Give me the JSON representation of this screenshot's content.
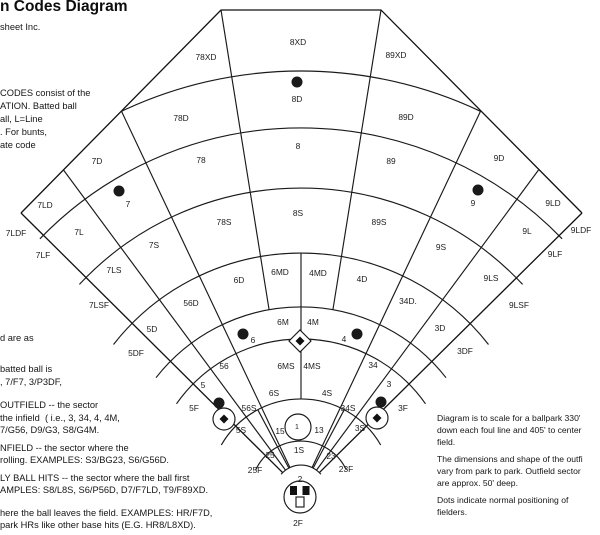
{
  "header": {
    "title": "n Codes Diagram",
    "subtitle": "sheet Inc."
  },
  "text_blocks": {
    "intro": {
      "x": 0,
      "lines": [
        {
          "text": "CODES consist of the",
          "y": 87
        },
        {
          "text": "ATION. Batted ball",
          "y": 100
        },
        {
          "text": "all, L=Line",
          "y": 113
        },
        {
          "text": ". For bunts,",
          "y": 126
        },
        {
          "text": "ate code",
          "y": 139
        }
      ]
    },
    "mid_left": {
      "x": 0,
      "lines": [
        {
          "text": "d are as",
          "y": 332
        },
        {
          "text": "batted ball is",
          "y": 363
        },
        {
          "text": ", 7/F7, 3/P3DF,",
          "y": 376
        }
      ]
    },
    "lower_left": {
      "x": 0,
      "lines": [
        {
          "text": "OUTFIELD -- the sector",
          "y": 399
        },
        {
          "text": "the infield  ( i.e., 3, 34, 4, 4M,",
          "y": 412
        },
        {
          "text": "7/G56, D9/G3, S8/G4M.",
          "y": 424
        },
        {
          "text": "NFIELD -- the sector where the",
          "y": 442
        },
        {
          "text": "rolling. EXAMPLES: S3/BG23, S6/G56D.",
          "y": 454
        },
        {
          "text": "LY BALL HITS -- the sector where the ball first",
          "y": 472
        },
        {
          "text": "AMPLES: S8/L8S, S6/P56D, D7/F7LD, T9/F89XD.",
          "y": 484
        },
        {
          "text": "here the ball leaves the field. EXAMPLES: HR/F7D,",
          "y": 507
        },
        {
          "text": "park HRs like other base hits (E.G. HR8/L8XD).",
          "y": 519
        }
      ]
    },
    "right": {
      "x": 437,
      "lines": [
        {
          "text": "Diagram is to scale for a ballpark 330'",
          "y": 412
        },
        {
          "text": "down each foul line and 405' to center",
          "y": 424
        },
        {
          "text": "field.",
          "y": 436
        },
        {
          "text": "The dimensions and shape of the outfi",
          "y": 453
        },
        {
          "text": "vary from park to park. Outfield sector",
          "y": 465
        },
        {
          "text": "are approx. 50' deep.",
          "y": 477
        },
        {
          "text": "Dots indicate normal positioning of",
          "y": 494
        },
        {
          "text": "fielders.",
          "y": 506
        }
      ]
    }
  },
  "field": {
    "sector_labels": [
      {
        "t": "78XD",
        "x": 206,
        "y": 57
      },
      {
        "t": "8XD",
        "x": 298,
        "y": 42
      },
      {
        "t": "89XD",
        "x": 396,
        "y": 55
      },
      {
        "t": "78D",
        "x": 181,
        "y": 118
      },
      {
        "t": "8D",
        "x": 297,
        "y": 99
      },
      {
        "t": "89D",
        "x": 406,
        "y": 117
      },
      {
        "t": "7D",
        "x": 97,
        "y": 161
      },
      {
        "t": "78",
        "x": 201,
        "y": 160
      },
      {
        "t": "8",
        "x": 298,
        "y": 146
      },
      {
        "t": "89",
        "x": 391,
        "y": 161
      },
      {
        "t": "9D",
        "x": 499,
        "y": 158
      },
      {
        "t": "7LD",
        "x": 45,
        "y": 205
      },
      {
        "t": "7",
        "x": 128,
        "y": 204
      },
      {
        "t": "78S",
        "x": 224,
        "y": 222
      },
      {
        "t": "8S",
        "x": 298,
        "y": 213
      },
      {
        "t": "89S",
        "x": 379,
        "y": 222
      },
      {
        "t": "9",
        "x": 473,
        "y": 203
      },
      {
        "t": "9LD",
        "x": 553,
        "y": 203
      },
      {
        "t": "7LDF",
        "x": 16,
        "y": 233
      },
      {
        "t": "7L",
        "x": 79,
        "y": 232
      },
      {
        "t": "7S",
        "x": 154,
        "y": 245
      },
      {
        "t": "9S",
        "x": 441,
        "y": 247
      },
      {
        "t": "9L",
        "x": 527,
        "y": 231
      },
      {
        "t": "9LDF",
        "x": 581,
        "y": 230
      },
      {
        "t": "7LF",
        "x": 43,
        "y": 255
      },
      {
        "t": "7LS",
        "x": 114,
        "y": 270
      },
      {
        "t": "9LS",
        "x": 491,
        "y": 278
      },
      {
        "t": "9LF",
        "x": 555,
        "y": 254
      },
      {
        "t": "7LSF",
        "x": 99,
        "y": 305
      },
      {
        "t": "56D",
        "x": 191,
        "y": 303
      },
      {
        "t": "6D",
        "x": 239,
        "y": 280
      },
      {
        "t": "6MD",
        "x": 280,
        "y": 272
      },
      {
        "t": "4MD",
        "x": 318,
        "y": 273
      },
      {
        "t": "4D",
        "x": 362,
        "y": 279
      },
      {
        "t": "34D.",
        "x": 408,
        "y": 301
      },
      {
        "t": "9LSF",
        "x": 519,
        "y": 305
      },
      {
        "t": "5D",
        "x": 152,
        "y": 329
      },
      {
        "t": "6M",
        "x": 283,
        "y": 322
      },
      {
        "t": "4M",
        "x": 313,
        "y": 322
      },
      {
        "t": "3D",
        "x": 440,
        "y": 328
      },
      {
        "t": "5DF",
        "x": 136,
        "y": 353
      },
      {
        "t": "6",
        "x": 253,
        "y": 340
      },
      {
        "t": "4",
        "x": 344,
        "y": 339
      },
      {
        "t": "3DF",
        "x": 465,
        "y": 351
      },
      {
        "t": "56",
        "x": 224,
        "y": 366
      },
      {
        "t": "6MS",
        "x": 286,
        "y": 366
      },
      {
        "t": "4MS",
        "x": 312,
        "y": 366
      },
      {
        "t": "34",
        "x": 373,
        "y": 365
      },
      {
        "t": "5",
        "x": 203,
        "y": 385
      },
      {
        "t": "6S",
        "x": 274,
        "y": 393
      },
      {
        "t": "4S",
        "x": 327,
        "y": 393
      },
      {
        "t": "3",
        "x": 389,
        "y": 384
      },
      {
        "t": "5F",
        "x": 194,
        "y": 408
      },
      {
        "t": "56S",
        "x": 249,
        "y": 408
      },
      {
        "t": "34S",
        "x": 348,
        "y": 408
      },
      {
        "t": "3F",
        "x": 403,
        "y": 408
      },
      {
        "t": "5S",
        "x": 241,
        "y": 430
      },
      {
        "t": "15",
        "x": 280,
        "y": 431
      },
      {
        "t": "1",
        "x": 297,
        "y": 426,
        "s": "small"
      },
      {
        "t": "13",
        "x": 319,
        "y": 430
      },
      {
        "t": "3S",
        "x": 360,
        "y": 428
      },
      {
        "t": "25",
        "x": 270,
        "y": 455
      },
      {
        "t": "1S",
        "x": 299,
        "y": 450
      },
      {
        "t": "23",
        "x": 331,
        "y": 456
      },
      {
        "t": "25F",
        "x": 255,
        "y": 470
      },
      {
        "t": "23F",
        "x": 346,
        "y": 469
      },
      {
        "t": "2",
        "x": 300,
        "y": 479
      },
      {
        "t": "2F",
        "x": 298,
        "y": 523
      }
    ],
    "fielder_dots": [
      {
        "pos": "center-fielder-8",
        "x": 297,
        "y": 82
      },
      {
        "pos": "left-fielder-7",
        "x": 119,
        "y": 191
      },
      {
        "pos": "right-fielder-9",
        "x": 478,
        "y": 190
      },
      {
        "pos": "shortstop-6",
        "x": 243,
        "y": 334
      },
      {
        "pos": "second-baseman-4",
        "x": 357,
        "y": 334
      },
      {
        "pos": "third-baseman-5",
        "x": 219,
        "y": 403
      },
      {
        "pos": "first-baseman-3",
        "x": 381,
        "y": 402
      }
    ],
    "line_color": "#1a1a1a"
  }
}
